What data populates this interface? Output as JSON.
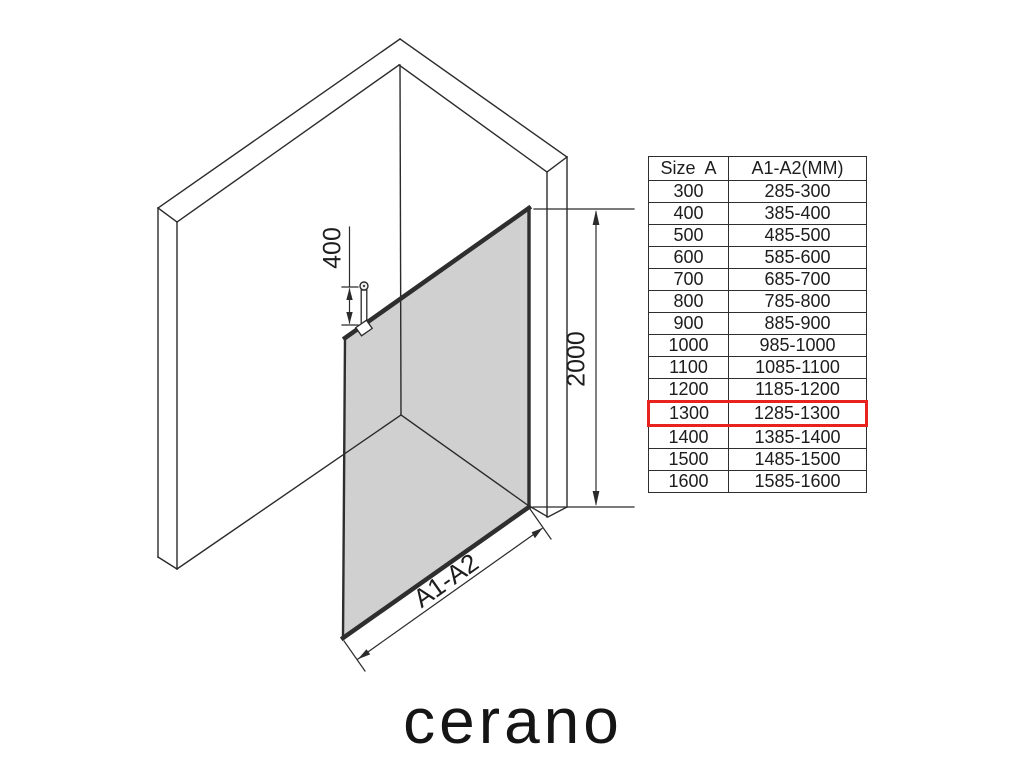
{
  "page": {
    "background": "#ffffff"
  },
  "logo": {
    "text": "cerano"
  },
  "diagram": {
    "description": "isometric walk-in shower glass panel between two walls",
    "line_color": "#2b2b2b",
    "glass_color": "#aaaaaa",
    "labels": {
      "support_bar_length": "400",
      "panel_height": "2000",
      "panel_width": "A1-A2"
    }
  },
  "table": {
    "headers": {
      "size": "Size  A",
      "range": "A1-A2(MM)"
    },
    "highlight_color": "#e8231f",
    "rows": [
      {
        "size": "300",
        "range": "285-300",
        "highlight": false
      },
      {
        "size": "400",
        "range": "385-400",
        "highlight": false
      },
      {
        "size": "500",
        "range": "485-500",
        "highlight": false
      },
      {
        "size": "600",
        "range": "585-600",
        "highlight": false
      },
      {
        "size": "700",
        "range": "685-700",
        "highlight": false
      },
      {
        "size": "800",
        "range": "785-800",
        "highlight": false
      },
      {
        "size": "900",
        "range": "885-900",
        "highlight": false
      },
      {
        "size": "1000",
        "range": "985-1000",
        "highlight": false
      },
      {
        "size": "1100",
        "range": "1085-1100",
        "highlight": false
      },
      {
        "size": "1200",
        "range": "1185-1200",
        "highlight": false
      },
      {
        "size": "1300",
        "range": "1285-1300",
        "highlight": true
      },
      {
        "size": "1400",
        "range": "1385-1400",
        "highlight": false
      },
      {
        "size": "1500",
        "range": "1485-1500",
        "highlight": false
      },
      {
        "size": "1600",
        "range": "1585-1600",
        "highlight": false
      }
    ]
  }
}
